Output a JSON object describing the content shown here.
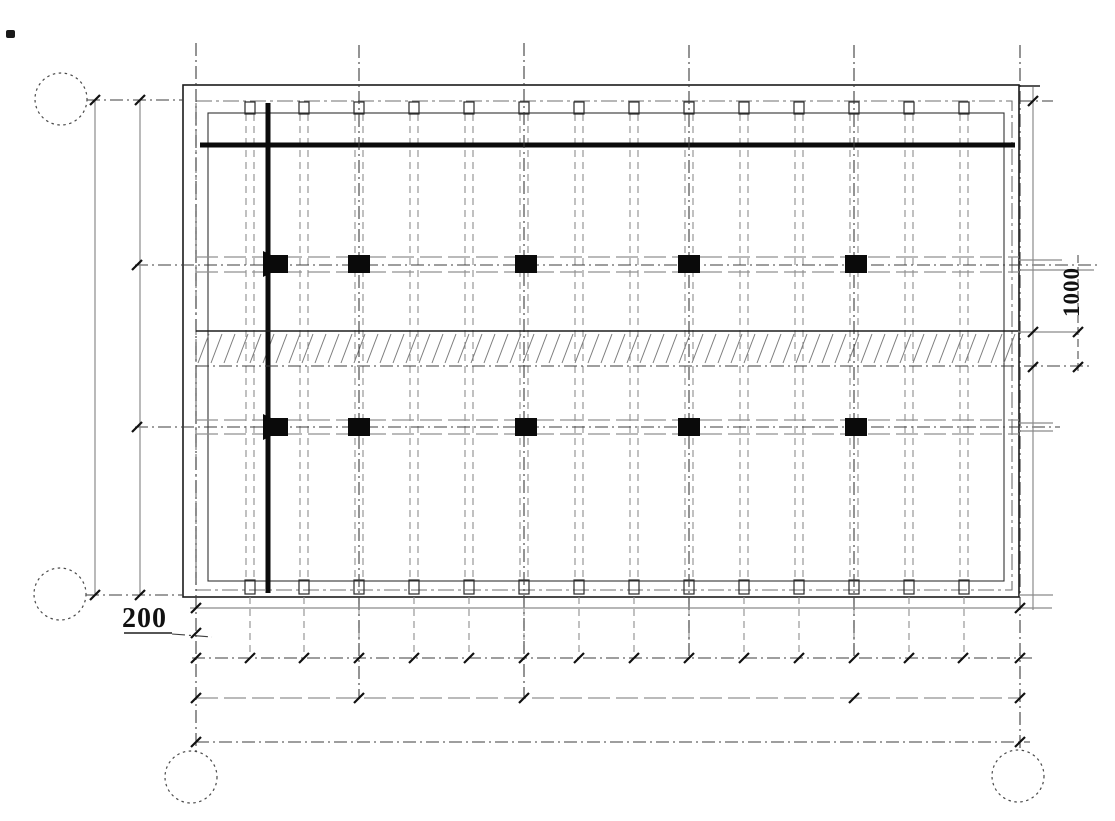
{
  "labels": {
    "dim_200": "200",
    "dim_1000": "1000"
  },
  "drawing": {
    "width": 1115,
    "height": 821,
    "styles": {
      "thick": {
        "s": "#0b0b0b",
        "w": 5
      },
      "grid": {
        "s": "#3d3d3d",
        "w": 1.1,
        "da": "13 4 2 4"
      },
      "gray": {
        "s": "#8b8b8b",
        "w": 1.2
      },
      "beamEdge": {
        "s": "#909090",
        "w": 1.2,
        "da": "22 6"
      },
      "thin": {
        "s": "#1f1f1f",
        "w": 1.4
      },
      "dim": {
        "s": "#3d3d3d",
        "w": 1,
        "da": "8 4"
      },
      "rib": {
        "s": "#8e8e8e",
        "w": 1.1,
        "da": "7 5"
      },
      "ribEnd": {
        "s": "#2a2a2a",
        "w": 1.2
      },
      "bubble": {
        "s": "#4a4a4a",
        "w": 1.2,
        "da": "2.5 3.5"
      },
      "wallOuter": {
        "s": "#1c1c1c",
        "w": 1.6
      },
      "wallMid": {
        "s": "#6f6f6f",
        "w": 1.1,
        "da": "16 4 3 4"
      },
      "wallInner": {
        "s": "#333333",
        "w": 1.1
      },
      "hatch": {
        "s": "#7d7d7d",
        "w": 1
      },
      "tick": {
        "s": "#111111",
        "w": 2.2
      },
      "columnFill": "#0a0a0a"
    },
    "circles": [
      {
        "cx": 61,
        "cy": 99,
        "r": 26
      },
      {
        "cx": 60,
        "cy": 594,
        "r": 26
      },
      {
        "cx": 191,
        "cy": 777,
        "r": 26
      },
      {
        "cx": 1018,
        "cy": 776,
        "r": 26
      }
    ],
    "wall_rects": [
      {
        "x": 183,
        "y": 85,
        "w": 836,
        "h": 512,
        "style": "wallOuter"
      },
      {
        "x": 196,
        "y": 101,
        "w": 816,
        "h": 489,
        "style": "wallMid"
      },
      {
        "x": 208,
        "y": 113,
        "w": 796,
        "h": 468,
        "style": "wallInner"
      }
    ],
    "lines": [
      [
        200,
        145,
        1015,
        145,
        "thick"
      ],
      [
        268,
        103,
        268,
        593,
        "thick"
      ],
      [
        196,
        43,
        196,
        751,
        "grid"
      ],
      [
        359,
        45,
        359,
        698,
        "grid"
      ],
      [
        524,
        43,
        524,
        698,
        "grid"
      ],
      [
        689,
        45,
        689,
        658,
        "grid"
      ],
      [
        854,
        45,
        854,
        658,
        "grid"
      ],
      [
        1020,
        45,
        1020,
        750,
        "grid"
      ],
      [
        87,
        100,
        183,
        100,
        "grid"
      ],
      [
        1019,
        101,
        1053,
        101,
        "grid"
      ],
      [
        86,
        595,
        183,
        595,
        "grid"
      ],
      [
        135,
        265,
        1098,
        265,
        "grid"
      ],
      [
        135,
        427,
        1060,
        427,
        "grid"
      ],
      [
        196,
        366,
        1090,
        366,
        "grid"
      ],
      [
        192,
        658,
        1032,
        658,
        "grid"
      ],
      [
        196,
        742,
        1030,
        742,
        "grid"
      ],
      [
        172,
        634,
        212,
        637,
        "grid"
      ],
      [
        95,
        100,
        95,
        595,
        "gray"
      ],
      [
        140,
        100,
        140,
        595,
        "gray"
      ],
      [
        190,
        608,
        1052,
        608,
        "gray"
      ],
      [
        1033,
        87,
        1033,
        610,
        "gray"
      ],
      [
        1019,
        260,
        1062,
        260,
        "gray"
      ],
      [
        1019,
        270,
        1094,
        270,
        "gray"
      ],
      [
        1018,
        332,
        1080,
        332,
        "gray"
      ],
      [
        1019,
        423,
        1053,
        423,
        "gray"
      ],
      [
        1019,
        431,
        1053,
        431,
        "gray"
      ],
      [
        1019,
        595,
        1053,
        595,
        "gray"
      ],
      [
        196,
        257,
        1019,
        257,
        "beamEdge"
      ],
      [
        196,
        272,
        1019,
        272,
        "beamEdge"
      ],
      [
        196,
        420,
        1019,
        420,
        "beamEdge"
      ],
      [
        196,
        434,
        1019,
        434,
        "beamEdge"
      ],
      [
        196,
        698,
        1020,
        698,
        "beamEdge"
      ],
      [
        196,
        331,
        1018,
        331,
        "thin"
      ],
      [
        124,
        633,
        172,
        633,
        "thin"
      ],
      [
        1019,
        86,
        1040,
        86,
        "thin"
      ],
      [
        1078,
        255,
        1078,
        375,
        "dim"
      ]
    ],
    "ribs": {
      "xs": [
        250,
        304,
        359,
        414,
        469,
        524,
        579,
        634,
        689,
        744,
        799,
        854,
        909,
        964
      ],
      "dx": 4,
      "y_top": 114,
      "y_bottom": 580,
      "stub_y1": 597,
      "stub_y2": 657,
      "end_top_y": 102,
      "end_top_h": 12,
      "end_bottom_y": 580,
      "end_bottom_h": 14,
      "end_w": 10
    },
    "columns": {
      "row_tops": [
        255,
        418
      ],
      "height": 18,
      "centers": [
        359,
        526,
        689,
        856
      ],
      "width": 22,
      "flags": [
        "263,251 271,255 288,255 288,273 271,273 263,277",
        "263,414 271,418 288,418 288,436 271,436 263,440"
      ]
    },
    "hatch": {
      "x_start": 198,
      "x_end": 1008,
      "step": 13,
      "y_low": 363,
      "y_high": 334,
      "run": 11
    },
    "ticks": [
      [
        95,
        100
      ],
      [
        140,
        100
      ],
      [
        95,
        595
      ],
      [
        140,
        595
      ],
      [
        137,
        265
      ],
      [
        137,
        427
      ],
      [
        196,
        633
      ],
      [
        1078,
        332
      ],
      [
        1078,
        367
      ],
      [
        1033,
        101
      ],
      [
        1033,
        332
      ],
      [
        1033,
        367
      ],
      [
        196,
        608
      ],
      [
        1020,
        608
      ],
      [
        196,
        658
      ],
      [
        250,
        658
      ],
      [
        304,
        658
      ],
      [
        359,
        658
      ],
      [
        414,
        658
      ],
      [
        469,
        658
      ],
      [
        524,
        658
      ],
      [
        579,
        658
      ],
      [
        634,
        658
      ],
      [
        689,
        658
      ],
      [
        744,
        658
      ],
      [
        799,
        658
      ],
      [
        854,
        658
      ],
      [
        909,
        658
      ],
      [
        963,
        658
      ],
      [
        1020,
        658
      ],
      [
        196,
        698
      ],
      [
        359,
        698
      ],
      [
        524,
        698
      ],
      [
        854,
        698
      ],
      [
        1020,
        698
      ],
      [
        196,
        742
      ],
      [
        1020,
        742
      ]
    ]
  }
}
